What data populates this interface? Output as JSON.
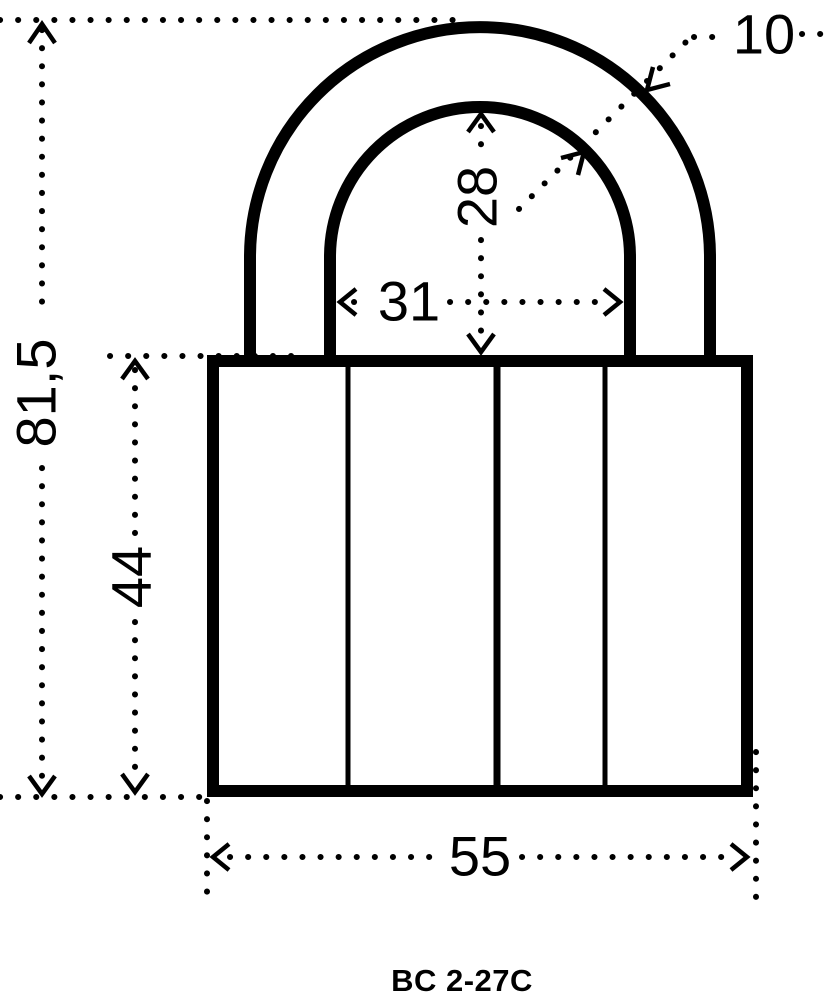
{
  "drawing": {
    "model_label": "BC 2-27C",
    "colors": {
      "line": "#000000",
      "background": "#ffffff"
    },
    "dimensions": {
      "total_height": {
        "label": "81,5"
      },
      "body_height": {
        "label": "44"
      },
      "shackle_inner_width": {
        "label": "31"
      },
      "shackle_inner_height": {
        "label": "28"
      },
      "shackle_diameter": {
        "label": "10"
      },
      "body_width": {
        "label": "55"
      }
    }
  }
}
